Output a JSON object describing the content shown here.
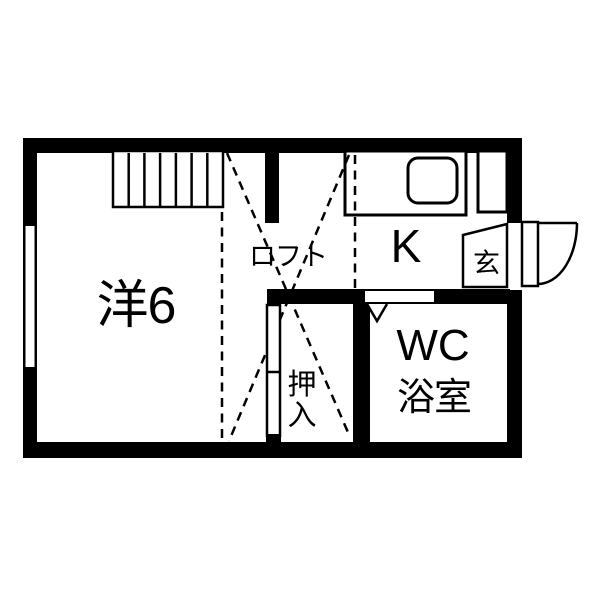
{
  "floorplan": {
    "type": "japanese-apartment-floor-plan",
    "labels": {
      "western_room": "洋6",
      "loft": "ロフト",
      "kitchen": "K",
      "entrance": "玄",
      "closet": [
        "押",
        "入"
      ],
      "wc": "WC",
      "bath": "浴室"
    },
    "colors": {
      "wall": "#000000",
      "line": "#000000",
      "floor": "#ffffff",
      "background": "#ffffff"
    },
    "features": [
      "staircase-to-loft",
      "loft-area-dashed-outline",
      "kitchen-counter-with-sink",
      "entrance-swing-door",
      "bathroom-folding-door",
      "closet-sliding-door",
      "window-on-left-wall"
    ]
  }
}
